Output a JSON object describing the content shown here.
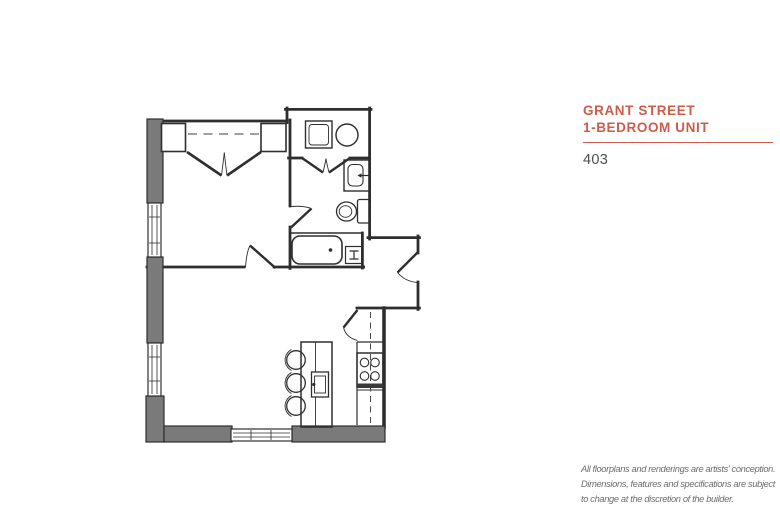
{
  "page": {
    "background_color": "#ffffff"
  },
  "info_panel": {
    "title_line1": "GRANT STREET",
    "title_line2": "1-BEDROOM UNIT",
    "unit_number": "403",
    "accent_color": "#cf5b4a",
    "disclaimer_lines": [
      "All floorplans and renderings are artists' conception.",
      "Dimensions, features and specifications are subject",
      "to change at the discretion of the builder."
    ]
  },
  "floorplan": {
    "wall_fill_color": "#7a7a7a",
    "line_color": "#2e2e2e",
    "fixtures": [
      "bedroom-closet-double-doors",
      "washer",
      "dryer",
      "vanity-sink",
      "toilet",
      "bathtub",
      "floor-register",
      "kitchen-island",
      "island-sink",
      "bar-stools",
      "range-cooktop",
      "upper-cabinet-dashed-line",
      "bedroom-door",
      "bathroom-door",
      "entry-door",
      "pantry-door",
      "windows"
    ]
  }
}
